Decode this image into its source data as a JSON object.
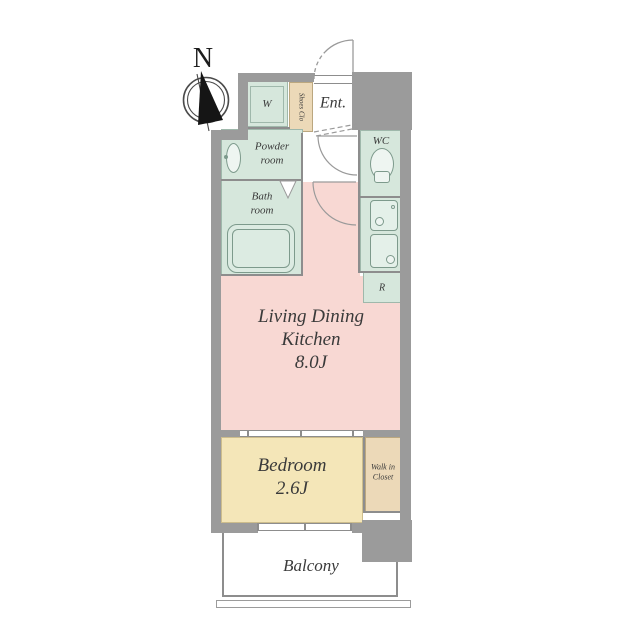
{
  "colors": {
    "wall": "#9b9b9b",
    "line": "#8d8d8d",
    "wet-green": "#d6e7dc",
    "closet-tan": "#ecd9b8",
    "ldk-pink": "#f8d8d3",
    "bedroom-yellow": "#f4e6b8",
    "ink": "#3a3a3a"
  },
  "compass": {
    "north_label": "N"
  },
  "rooms": {
    "entrance": {
      "label": "Ent."
    },
    "washer_space": {
      "label": "W"
    },
    "shoes_closet": {
      "label": "Shoes Clo"
    },
    "powder_room": {
      "line1": "Powder",
      "line2": "room"
    },
    "bath_room": {
      "line1": "Bath",
      "line2": "room"
    },
    "wc": {
      "label": "WC"
    },
    "refrigerator_space": {
      "label": "R"
    },
    "living_dining_kitchen": {
      "line1": "Living Dining",
      "line2": "Kitchen",
      "size": "8.0J"
    },
    "bedroom": {
      "label": "Bedroom",
      "size": "2.6J"
    },
    "walk_in_closet": {
      "line1": "Walk in",
      "line2": "Closet"
    },
    "balcony": {
      "label": "Balcony"
    }
  }
}
